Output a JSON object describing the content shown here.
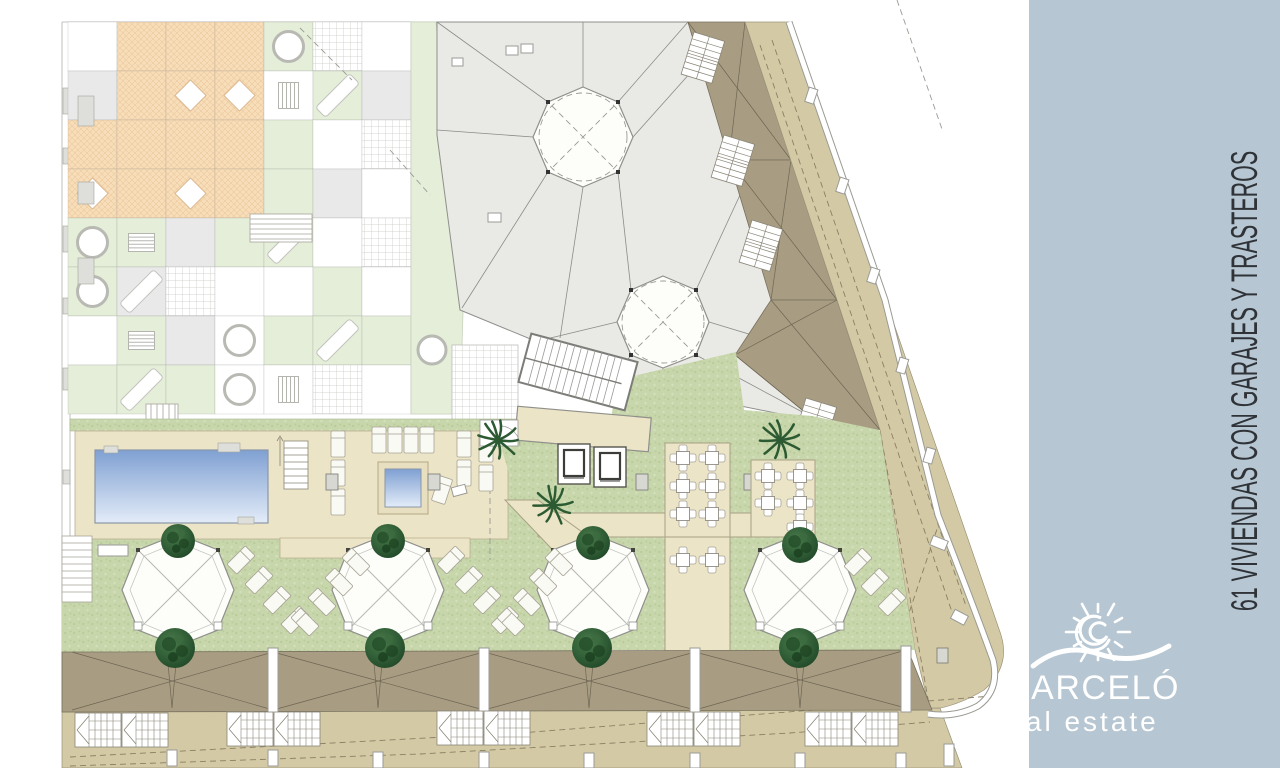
{
  "sidebar": {
    "title": "61 VIVIENDAS CON GARAJES Y TRASTEROS",
    "logo": {
      "brand": "BARCELÓ",
      "tagline": "real estate"
    }
  },
  "colors": {
    "sidebar_bg": "#b6c6d2",
    "sidebar_title": "#2f3338",
    "logo_color": "#ffffff",
    "roof_gray": "#e9e9e6",
    "roof_brown": "#a89d83",
    "terrace_tan": "#d3caa5",
    "lawn_green": "#c7d6ab",
    "lawn_dot": "#b9cc97",
    "lawn_dot2": "#d4e0bb",
    "deck_beige": "#ece4c6",
    "tile_green": "#e4eed8",
    "tile_gray": "#e9e9e9",
    "tile_orange": "#f7ddb9",
    "pool_dark": "#7fa0d2",
    "pool_light": "#e3ecf8",
    "tree_dark": "#1f4526",
    "tree_mid": "#2f5c35",
    "tree_light": "#4a7a4b"
  },
  "plan": {
    "terrace_tiles": {
      "rows": [
        "wooochwg",
        "yoxxvdyg",
        "oooogwhc",
        "xoxogywv",
        "csygdwhg",
        "cDhwwgwy",
        "wsyCgdgc",
        "gdgCvhwg"
      ]
    }
  }
}
